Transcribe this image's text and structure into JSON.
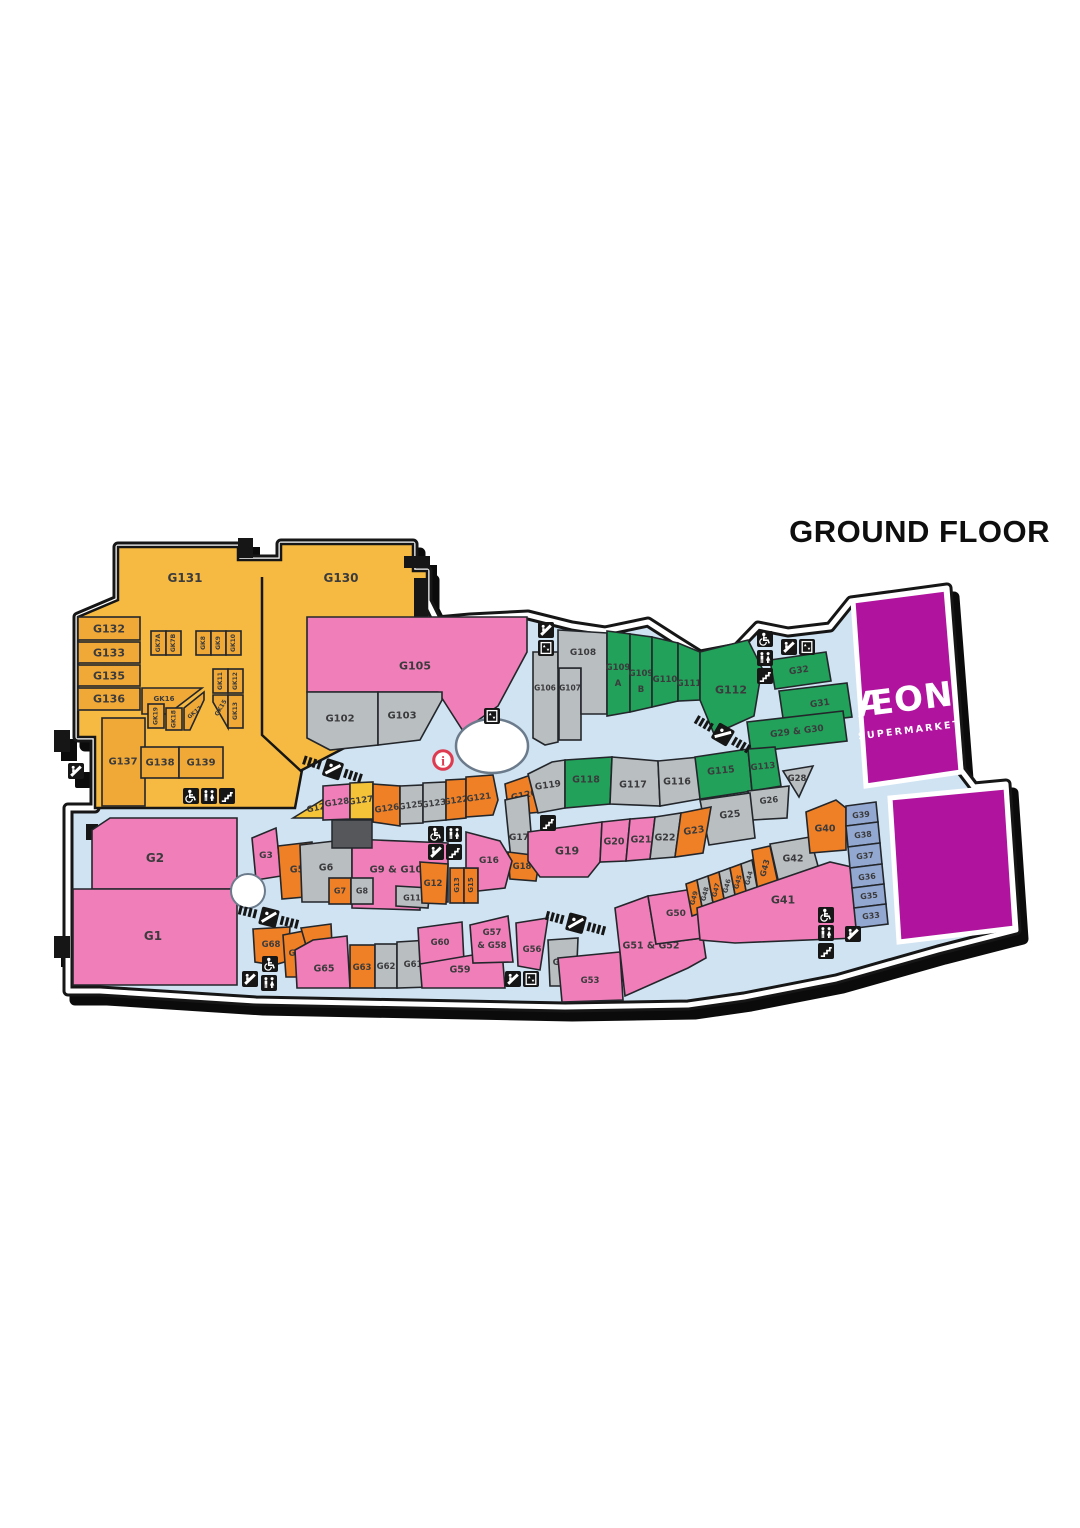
{
  "title": "GROUND FLOOR",
  "anchor_store": {
    "name": "ÆON",
    "sub": "SUPERMARKET"
  },
  "colors": {
    "amber": "#F0A936",
    "amberZone": "#F6BA42",
    "pink": "#F07EB9",
    "gray": "#B9BEC1",
    "green": "#21A159",
    "orange": "#F08026",
    "yellow": "#F5C337",
    "blue": "#93A8D0",
    "purple": "#B0149E",
    "walkway": "#CFE3F2",
    "outline": "#161616",
    "service": "#55575B",
    "infoRed": "#DE3A50"
  },
  "units": [
    {
      "id": "G131",
      "label": "G131",
      "color": "amber"
    },
    {
      "id": "G130",
      "label": "G130",
      "color": "amber"
    },
    {
      "id": "G132",
      "label": "G132",
      "color": "amber"
    },
    {
      "id": "G133",
      "label": "G133",
      "color": "amber"
    },
    {
      "id": "G135",
      "label": "G135",
      "color": "amber"
    },
    {
      "id": "G136",
      "label": "G136",
      "color": "amber"
    },
    {
      "id": "G137",
      "label": "G137",
      "color": "amber"
    },
    {
      "id": "G138",
      "label": "G138",
      "color": "amber"
    },
    {
      "id": "G139",
      "label": "G139",
      "color": "amber"
    },
    {
      "id": "GK7A",
      "label": "GK7A",
      "color": "amber"
    },
    {
      "id": "GK7B",
      "label": "GK7B",
      "color": "amber"
    },
    {
      "id": "GK8",
      "label": "GK8",
      "color": "amber"
    },
    {
      "id": "GK9",
      "label": "GK9",
      "color": "amber"
    },
    {
      "id": "GK10",
      "label": "GK10",
      "color": "amber"
    },
    {
      "id": "GK11",
      "label": "GK11",
      "color": "amber"
    },
    {
      "id": "GK12",
      "label": "GK12",
      "color": "amber"
    },
    {
      "id": "GK15",
      "label": "GK15",
      "color": "amber"
    },
    {
      "id": "GK13",
      "label": "GK13",
      "color": "amber"
    },
    {
      "id": "GK16",
      "label": "GK16",
      "color": "amber"
    },
    {
      "id": "GK19",
      "label": "GK19",
      "color": "amber"
    },
    {
      "id": "GK18",
      "label": "GK18",
      "color": "amber"
    },
    {
      "id": "GK17",
      "label": "GK17",
      "color": "amber"
    },
    {
      "id": "G105",
      "label": "G105",
      "color": "pink"
    },
    {
      "id": "G102",
      "label": "G102",
      "color": "gray"
    },
    {
      "id": "G103",
      "label": "G103",
      "color": "gray"
    },
    {
      "id": "G106",
      "label": "G106",
      "color": "gray"
    },
    {
      "id": "G107",
      "label": "G107",
      "color": "gray"
    },
    {
      "id": "G108",
      "label": "G108",
      "color": "gray"
    },
    {
      "id": "G109A",
      "label": "G109",
      "sub": "A",
      "color": "green"
    },
    {
      "id": "G109B",
      "label": "G109",
      "sub": "B",
      "color": "green"
    },
    {
      "id": "G110",
      "label": "G110",
      "color": "green"
    },
    {
      "id": "G111",
      "label": "G111",
      "color": "green"
    },
    {
      "id": "G112",
      "label": "G112",
      "color": "green"
    },
    {
      "id": "G32",
      "label": "G32",
      "color": "green"
    },
    {
      "id": "G31",
      "label": "G31",
      "color": "green"
    },
    {
      "id": "G29_30",
      "label": "G29 & G30",
      "color": "green"
    },
    {
      "id": "G120",
      "label": "G120",
      "color": "orange"
    },
    {
      "id": "G119",
      "label": "G119",
      "color": "gray"
    },
    {
      "id": "G118",
      "label": "G118",
      "color": "green"
    },
    {
      "id": "G117",
      "label": "G117",
      "color": "gray"
    },
    {
      "id": "G116",
      "label": "G116",
      "color": "gray"
    },
    {
      "id": "G115",
      "label": "G115",
      "color": "green"
    },
    {
      "id": "G113",
      "label": "G113",
      "color": "green"
    },
    {
      "id": "G28",
      "label": "G28",
      "color": "gray"
    },
    {
      "id": "G26",
      "label": "G26",
      "color": "gray"
    },
    {
      "id": "G25",
      "label": "G25",
      "color": "gray"
    },
    {
      "id": "G17",
      "label": "G17",
      "color": "gray"
    },
    {
      "id": "G18",
      "label": "G18",
      "color": "orange"
    },
    {
      "id": "G129",
      "label": "G129",
      "color": "yellow"
    },
    {
      "id": "G128",
      "label": "G128",
      "color": "pink"
    },
    {
      "id": "G127",
      "label": "G127",
      "color": "yellow"
    },
    {
      "id": "G126",
      "label": "G126",
      "color": "orange"
    },
    {
      "id": "G125",
      "label": "G125",
      "color": "gray"
    },
    {
      "id": "G123",
      "label": "G123",
      "color": "gray"
    },
    {
      "id": "G122",
      "label": "G122",
      "color": "orange"
    },
    {
      "id": "G121",
      "label": "G121",
      "color": "orange"
    },
    {
      "id": "G19",
      "label": "G19",
      "color": "pink"
    },
    {
      "id": "G20",
      "label": "G20",
      "color": "pink"
    },
    {
      "id": "G21",
      "label": "G21",
      "color": "pink"
    },
    {
      "id": "G22",
      "label": "G22",
      "color": "gray"
    },
    {
      "id": "G23",
      "label": "G23",
      "color": "orange"
    },
    {
      "id": "G2",
      "label": "G2",
      "color": "pink"
    },
    {
      "id": "G1",
      "label": "G1",
      "color": "pink"
    },
    {
      "id": "G3",
      "label": "G3",
      "color": "pink"
    },
    {
      "id": "G5",
      "label": "G5",
      "color": "orange"
    },
    {
      "id": "G6",
      "label": "G6",
      "color": "gray"
    },
    {
      "id": "G9_10",
      "label": "G9 & G10",
      "color": "pink"
    },
    {
      "id": "G7",
      "label": "G7",
      "color": "orange"
    },
    {
      "id": "G8",
      "label": "G8",
      "color": "gray"
    },
    {
      "id": "G11",
      "label": "G11",
      "color": "gray"
    },
    {
      "id": "G12",
      "label": "G12",
      "color": "orange"
    },
    {
      "id": "G13",
      "label": "G13",
      "color": "orange"
    },
    {
      "id": "G15",
      "label": "G15",
      "color": "orange"
    },
    {
      "id": "G16",
      "label": "G16",
      "color": "pink"
    },
    {
      "id": "G68",
      "label": "G68",
      "color": "orange"
    },
    {
      "id": "G67",
      "label": "G67",
      "color": "orange"
    },
    {
      "id": "G66",
      "label": "G66",
      "color": "orange"
    },
    {
      "id": "G65",
      "label": "G65",
      "color": "pink"
    },
    {
      "id": "G63",
      "label": "G63",
      "color": "orange"
    },
    {
      "id": "G62",
      "label": "G62",
      "color": "gray"
    },
    {
      "id": "G61",
      "label": "G61",
      "color": "gray"
    },
    {
      "id": "G60",
      "label": "G60",
      "color": "pink"
    },
    {
      "id": "G59",
      "label": "G59",
      "color": "pink"
    },
    {
      "id": "G57_58",
      "label": "G57",
      "sub": "& G58",
      "color": "pink"
    },
    {
      "id": "G56",
      "label": "G56",
      "color": "pink"
    },
    {
      "id": "G55",
      "label": "G55",
      "color": "gray"
    },
    {
      "id": "G53",
      "label": "G53",
      "color": "pink"
    },
    {
      "id": "G51_52",
      "label": "G51 & G52",
      "color": "pink"
    },
    {
      "id": "G50",
      "label": "G50",
      "color": "pink"
    },
    {
      "id": "G49",
      "label": "G49",
      "color": "orange"
    },
    {
      "id": "G48",
      "label": "G48",
      "color": "gray"
    },
    {
      "id": "G47",
      "label": "G47",
      "color": "orange"
    },
    {
      "id": "G46",
      "label": "G46",
      "color": "gray"
    },
    {
      "id": "G45",
      "label": "G45",
      "color": "orange"
    },
    {
      "id": "G44",
      "label": "G44",
      "color": "gray"
    },
    {
      "id": "G43",
      "label": "G43",
      "color": "orange"
    },
    {
      "id": "G42",
      "label": "G42",
      "color": "gray"
    },
    {
      "id": "G41",
      "label": "G41",
      "color": "pink"
    },
    {
      "id": "G40",
      "label": "G40",
      "color": "orange"
    },
    {
      "id": "G39",
      "label": "G39",
      "color": "blue"
    },
    {
      "id": "G38",
      "label": "G38",
      "color": "blue"
    },
    {
      "id": "G37",
      "label": "G37",
      "color": "blue"
    },
    {
      "id": "G36",
      "label": "G36",
      "color": "blue"
    },
    {
      "id": "G35",
      "label": "G35",
      "color": "blue"
    },
    {
      "id": "G33",
      "label": "G33",
      "color": "blue"
    }
  ],
  "icons": [
    {
      "name": "escalator-icon"
    },
    {
      "name": "elevator-icon"
    },
    {
      "name": "wheelchair-access-icon"
    },
    {
      "name": "toilets-icon"
    },
    {
      "name": "stairs-icon"
    },
    {
      "name": "escalator-icon"
    },
    {
      "name": "elevator-icon"
    },
    {
      "name": "travelator-icon"
    },
    {
      "name": "elevator-icon"
    },
    {
      "name": "information-icon"
    },
    {
      "name": "wheelchair-access-icon"
    },
    {
      "name": "toilets-icon"
    },
    {
      "name": "escalator-icon"
    },
    {
      "name": "stairs-icon"
    },
    {
      "name": "stairs-icon"
    },
    {
      "name": "travelator-icon"
    },
    {
      "name": "travelator-icon"
    },
    {
      "name": "escalator-icon"
    },
    {
      "name": "wheelchair-access-icon"
    },
    {
      "name": "toilets-icon"
    },
    {
      "name": "stairs-icon"
    },
    {
      "name": "wheelchair-access-icon"
    },
    {
      "name": "escalator-icon"
    },
    {
      "name": "toilets-icon"
    },
    {
      "name": "escalator-icon"
    },
    {
      "name": "elevator-icon"
    },
    {
      "name": "wheelchair-access-icon"
    },
    {
      "name": "toilets-icon"
    },
    {
      "name": "stairs-icon"
    },
    {
      "name": "escalator-icon"
    },
    {
      "name": "travelator-icon"
    }
  ]
}
